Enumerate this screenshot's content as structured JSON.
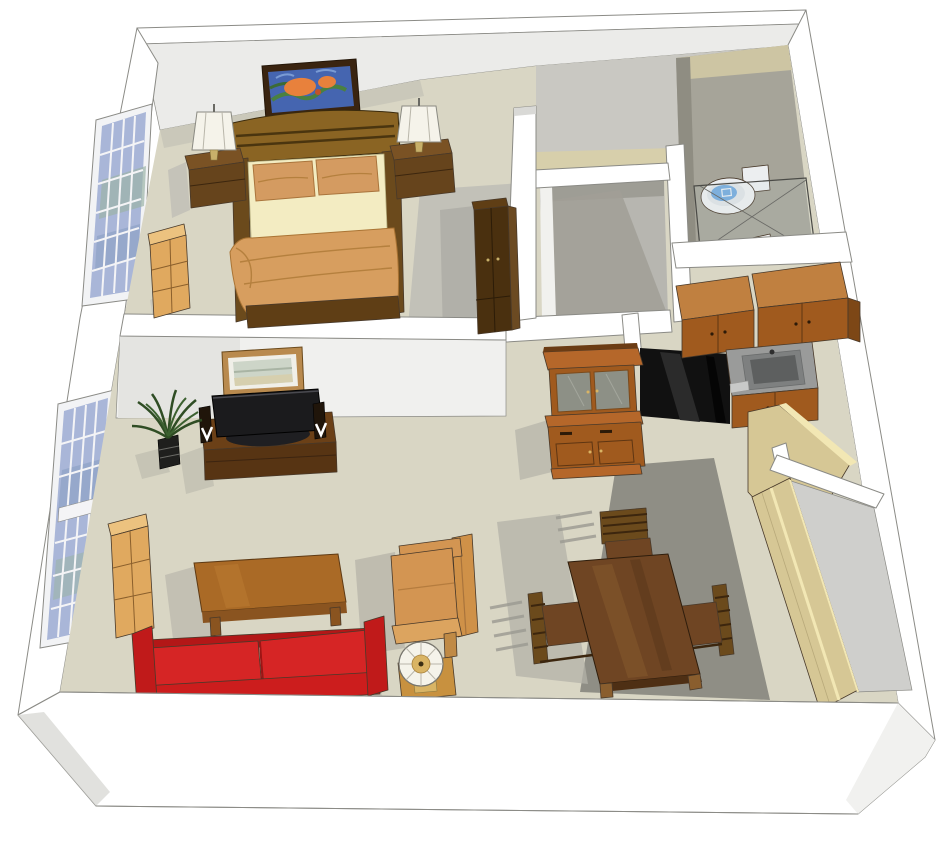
{
  "title": "3D isometric one-bedroom apartment floor plan",
  "palette": {
    "outline": "#8b8b86",
    "wall_white": "#ffffff",
    "wall_face_light": "#ebebe9",
    "wall_face_mid": "#d9d9d6",
    "wall_face_dark": "#c6c6c2",
    "floor": "#d9d6c4",
    "floor_shade_soft": "#c7c5b9",
    "floor_shade": "#8f8e85",
    "hall_beige": "#d7cfab",
    "hall_gray": "#c9c8c2",
    "bath_floor": "#a6a499",
    "bath_strip": "#cdc5a3",
    "closet_floor": "#b7b6b0",
    "closet_shade": "#a19f97",
    "wood_dark": "#4a300f",
    "wood_frame": "#6b4a1c",
    "wood_gold": "#8a6423",
    "wood_mid": "#a05a1e",
    "wood_mid_light": "#b5672a",
    "wood_top": "#c08040",
    "wood_side": "#7d4716",
    "wood_light": "#e0a95f",
    "wood_light_top": "#ecc27f",
    "table_brown": "#6f4523",
    "table_edge": "#4e2f14",
    "tv_wood": "#6b4017",
    "tv_wood_dark": "#573413",
    "cream": "#f3ecc2",
    "pillow": "#d49b61",
    "blanket": "#d79e5f",
    "sofa_red": "#d62525",
    "sofa_red_dark": "#b31717",
    "chair_tan": "#d39552",
    "chair_tan_light": "#dca45f",
    "chair_tan_dark": "#cf9148",
    "lamp_white": "#f5f3ea",
    "black": "#111111",
    "black_sheen": "#2b2b2b",
    "screen": "#1b1b1d",
    "sink": "#9a9b9a",
    "sink_dark": "#5d5f5f",
    "glass_pane": "#8d9086",
    "win_blue": "#a9b6d8",
    "win_blue2": "#8fa3c6",
    "win_green": "#9db4a8",
    "frame_white": "#f2f3f5",
    "door_tan": "#d6c795",
    "door_edge": "#f2e7b4",
    "plant": "#2f4d24",
    "plant_light": "#3c6130",
    "paint_blue": "#4565b0",
    "paint_green": "#4a8040",
    "paint_orange": "#e8813c",
    "frame_dark": "#3a2410",
    "toilet": "#eceef0",
    "water": "#74aadd",
    "gold": "#d9b464"
  },
  "scene": {
    "view": "3d-cutaway-top-perspective",
    "rooms": [
      {
        "name": "bedroom",
        "furniture": [
          "bed",
          "nightstand-left",
          "nightstand-right",
          "bedside-lamp-left",
          "bedside-lamp-right",
          "abstract-painting",
          "bedroom-window",
          "bedroom-dresser",
          "wardrobe"
        ]
      },
      {
        "name": "living-room",
        "furniture": [
          "red-sofa",
          "coffee-table",
          "armchair",
          "side-table",
          "round-table-lamp",
          "tv-console",
          "flat-tv",
          "speaker-left",
          "speaker-right",
          "potted-plant",
          "landscape-picture",
          "living-window",
          "bookcase"
        ]
      },
      {
        "name": "dining-area",
        "furniture": [
          "dining-table",
          "dining-chair-top",
          "dining-chair-left",
          "dining-chair-right"
        ]
      },
      {
        "name": "kitchen",
        "furniture": [
          "upper-cabinets",
          "sink-counter",
          "lower-cabinets",
          "black-counter-run",
          "entry-door-open"
        ]
      },
      {
        "name": "bathroom",
        "furniture": [
          "toilet",
          "shower-glass-enclosure",
          "shower-fixture"
        ]
      },
      {
        "name": "walk-in-closet",
        "furniture": []
      },
      {
        "name": "hallway",
        "furniture": [
          "hutch-cabinet"
        ]
      },
      {
        "name": "dining-closet",
        "furniture": [
          "sliding-doors"
        ]
      }
    ]
  }
}
